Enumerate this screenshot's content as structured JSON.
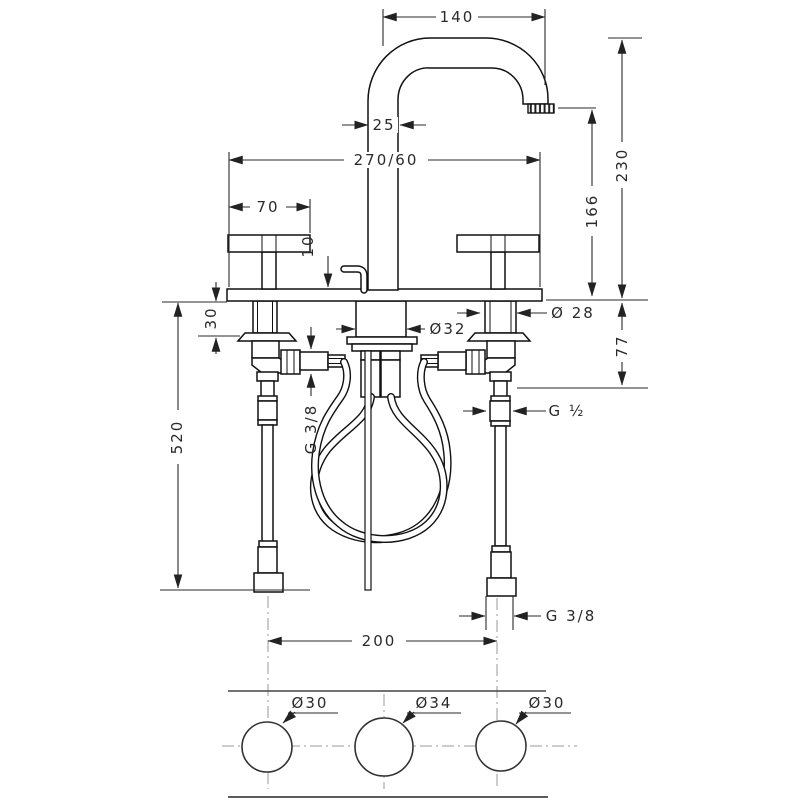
{
  "drawing": {
    "type": "technical-dimension-drawing",
    "subject": "3-hole basin mixer tap - front elevation with supply hoses and countertop drilling plan",
    "units": "mm",
    "colors": {
      "line": "#111111",
      "dim_text": "#2a2a2a",
      "centerline": "#9a9a9a",
      "background": "#ffffff"
    },
    "dims": {
      "spout_reach": "140",
      "spout_pipe": "25",
      "plate": "270/60",
      "handle_width": "70",
      "rod_offset": "10",
      "height_total": "230",
      "height_spout": "166",
      "deck_thickness": "30",
      "drain_dia": "Ø32",
      "shank_dia": "Ø 28",
      "depth_connection": "77",
      "hose_length": "520",
      "thread_center": "G 3/8",
      "thread_side": "G ½",
      "thread_bottom": "G 3/8",
      "hole_spacing": "200"
    },
    "plan": {
      "hole_left": "Ø30",
      "hole_center": "Ø34",
      "hole_right": "Ø30"
    }
  }
}
